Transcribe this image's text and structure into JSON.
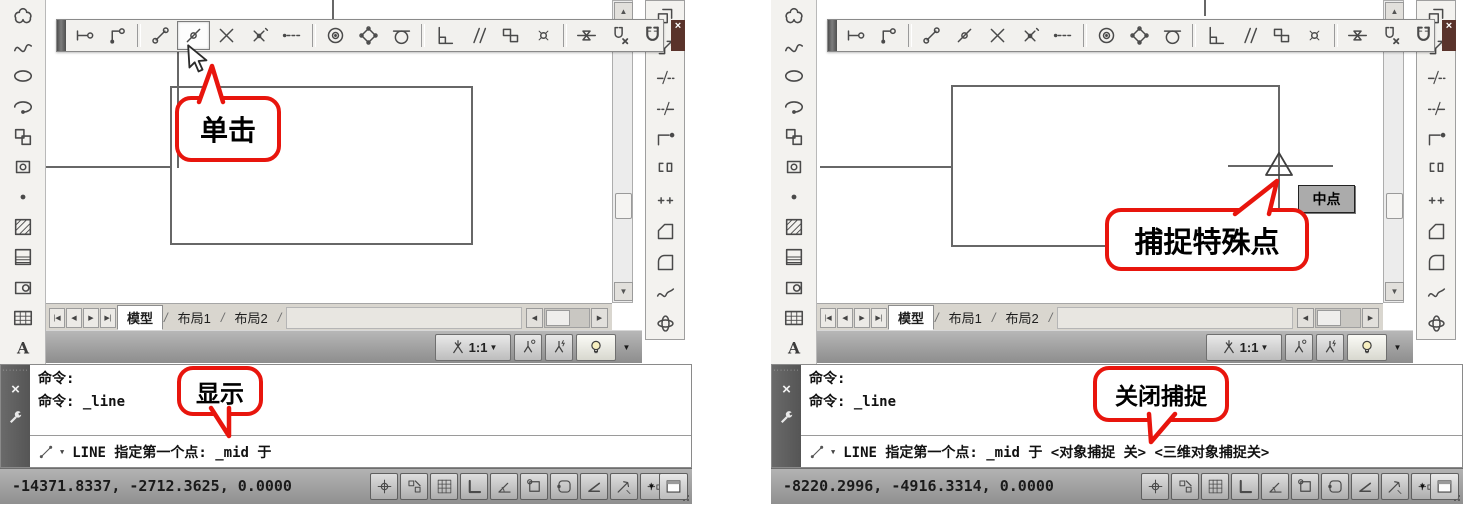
{
  "panels": {
    "left": {
      "title": "CAD window – clicking the midpoint snap button",
      "coords": "-14371.8337, -2712.3625, 0.0000",
      "command_line1": "命令:",
      "command_line2": "命令: _line",
      "prompt": "LINE 指定第一个点: _mid 于",
      "callouts": {
        "click": "单击",
        "display": "显示"
      }
    },
    "right": {
      "title": "CAD window – snapping the special point",
      "coords": "-8220.2996, -4916.3314, 0.0000",
      "command_line1": "命令:",
      "command_line2": "命令: _line",
      "prompt": "LINE 指定第一个点: _mid 于  <对象捕捉 关> <三维对象捕捉关>",
      "callouts": {
        "snap_special": "捕捉特殊点",
        "close_snap": "关闭捕捉"
      },
      "snap_tooltip": "中点"
    }
  },
  "tabs": {
    "model": "模型",
    "layout1": "布局1",
    "layout2": "布局2",
    "separator": "/"
  },
  "tab_nav": [
    "|◀",
    "◀",
    "▶",
    "▶|"
  ],
  "annotation": {
    "scale": "1:1"
  },
  "osnap_toolbar": [
    "temporary-track-point",
    "snap-from",
    "|",
    "snap-to-endpoint",
    "snap-to-midpoint",
    "snap-to-intersection",
    "snap-to-apparent-intersection",
    "snap-to-extension",
    "|",
    "snap-to-center",
    "snap-to-quadrant",
    "snap-to-tangent",
    "|",
    "snap-to-perpendicular",
    "snap-to-parallel",
    "snap-to-insertion",
    "snap-to-node",
    "|",
    "snap-to-nearest",
    "snap-to-none",
    "osnap-settings"
  ],
  "draw_toolbar": [
    "revision-cloud",
    "spline",
    "ellipse",
    "elliptical-arc",
    "insert-block",
    "make-block",
    "point",
    "hatch",
    "gradient",
    "region",
    "table",
    "multiline-text"
  ],
  "modify_toolbar": [
    "copy",
    "scale",
    "break-at-point",
    "break",
    "lengthen",
    "join",
    "stretch",
    "chamfer",
    "fillet",
    "blend-curves",
    "free-orbit"
  ],
  "status_toggles": [
    "infer-constraints",
    "snap-mode",
    "grid-display",
    "ortho-mode",
    "polar-tracking",
    "object-snap",
    "object-snap-tracking",
    "dynamic-ucs",
    "dynamic-input",
    "lineweight"
  ],
  "glyphs": {
    "close": "×",
    "caret_down": "▼",
    "scroll_up": "▲",
    "scroll_down": "▼",
    "scroll_left": "◀",
    "scroll_right": "▶",
    "grip_dots": "········"
  },
  "colors": {
    "callout_red": "#e8150d",
    "canvas": "#ffffff",
    "statusbar": "#9a9a9a",
    "toolbar": "#f2f1ee"
  }
}
